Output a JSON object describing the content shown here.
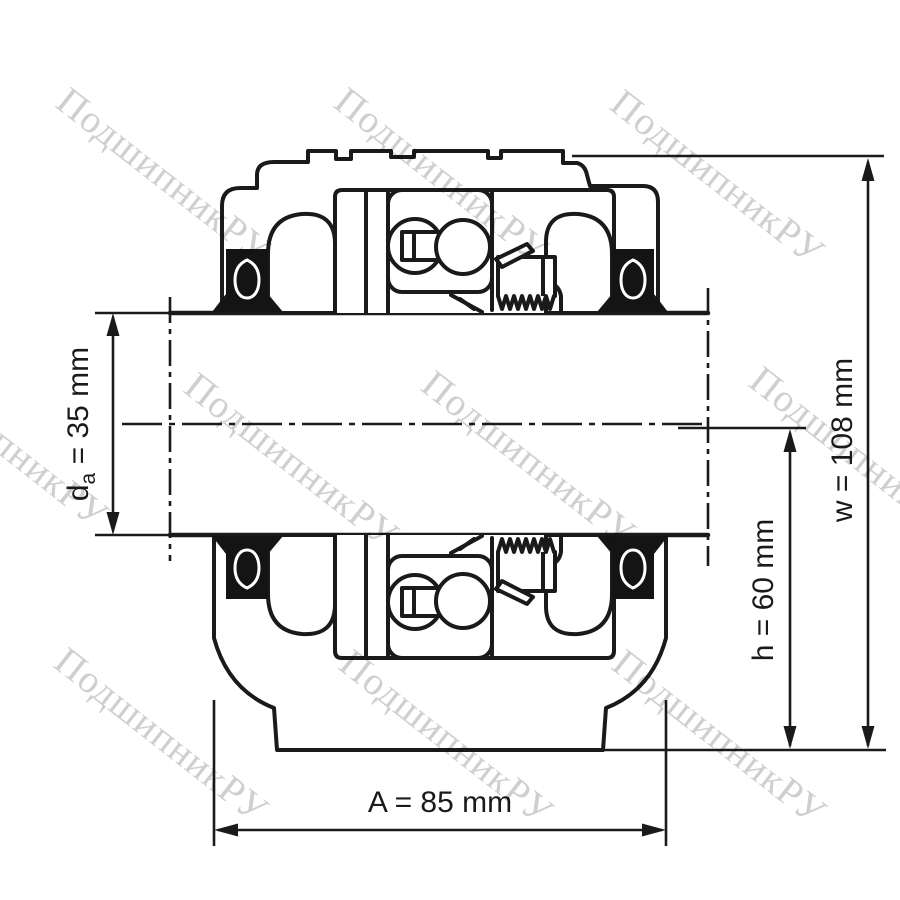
{
  "figure": {
    "type": "technical-drawing",
    "subject": "plummer-block-bearing-housing-cross-section",
    "background": "#ffffff",
    "line_color": "#1a1a1a",
    "housing_fill": "#d9d9d9",
    "seal_color": "#141414",
    "watermark_color": "#cfcfcf"
  },
  "watermark": {
    "text": "ПодшипникРУ"
  },
  "dimensions": {
    "shaft_diameter": {
      "symbol": "d",
      "subscript": "a",
      "value": " = 35 mm",
      "full": "da = 35 mm"
    },
    "housing_width": {
      "full": "A = 85 mm"
    },
    "center_height": {
      "full": "h = 60 mm"
    },
    "total_height": {
      "full": "w = 108 mm"
    }
  }
}
